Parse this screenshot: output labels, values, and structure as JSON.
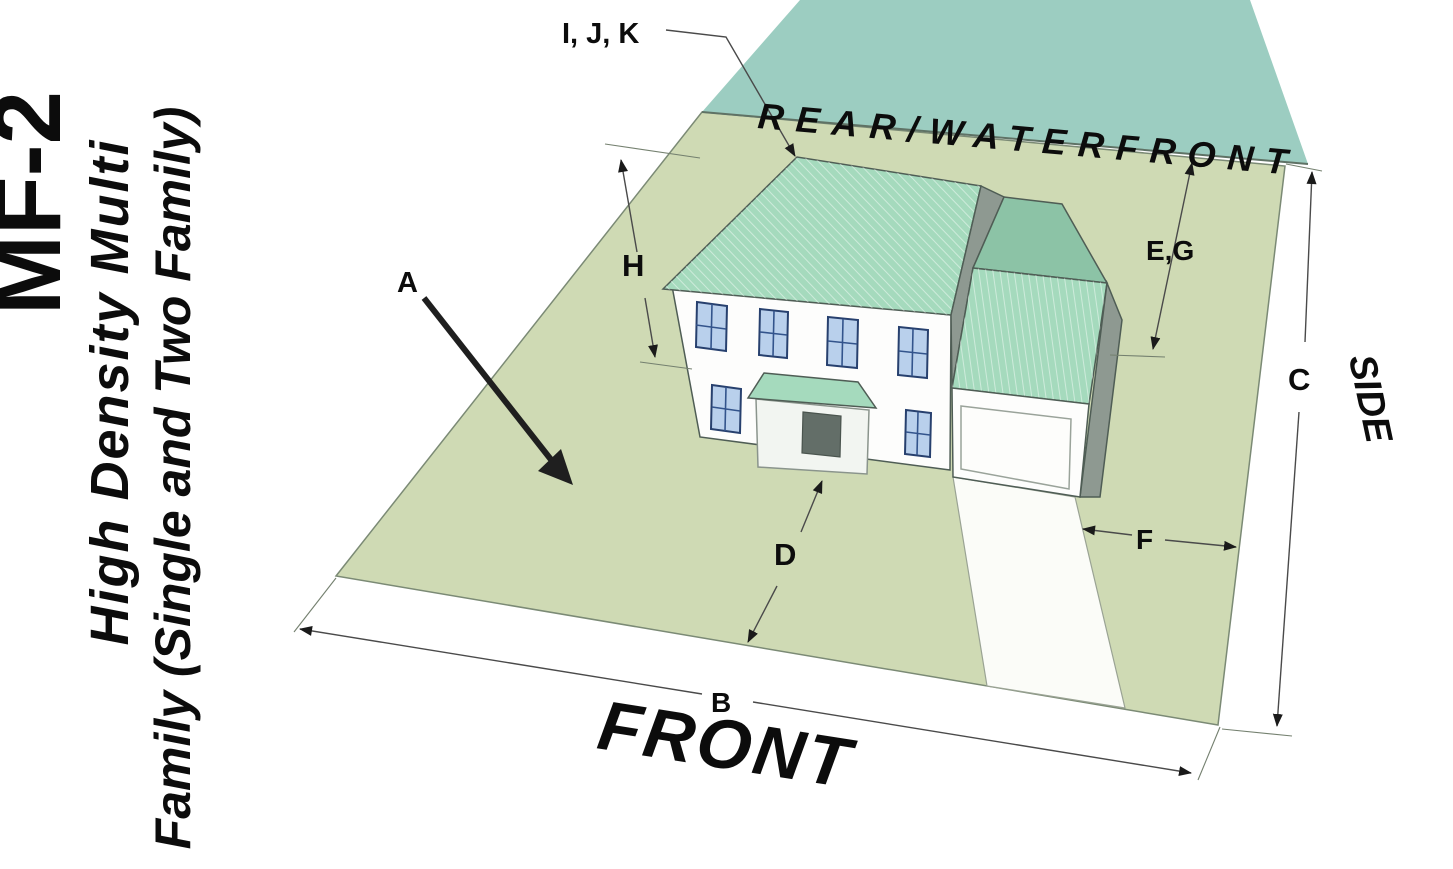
{
  "sidebar": {
    "zone_code": "MF-2",
    "zone_name_line1": "High Density Multi",
    "zone_name_line2": "Family (Single and Two Family)"
  },
  "diagram": {
    "boundary_labels": {
      "rear": "REAR/WATERFRONT",
      "front": "FRONT",
      "side": "SIDE"
    },
    "dimensions": {
      "a": "A",
      "b": "B",
      "c": "C",
      "d": "D",
      "e_g": "E,G",
      "f": "F",
      "h": "H",
      "i_j_k": "I, J, K"
    },
    "colors": {
      "lot": "#cfdab4",
      "water": "#9ccdc1",
      "roof": "#a5dabd",
      "roof_shaded": "#8cc3a6",
      "wall": "#fdfdfc",
      "gable_shade": "#8e9991",
      "porch": "#f2f5f1",
      "window": "#b9d0ec",
      "window_frame": "#27406e",
      "door": "#636e68",
      "driveway": "#fbfcf8",
      "dimension_line": "#4a4a4a",
      "label": "#0c0c0c"
    }
  }
}
